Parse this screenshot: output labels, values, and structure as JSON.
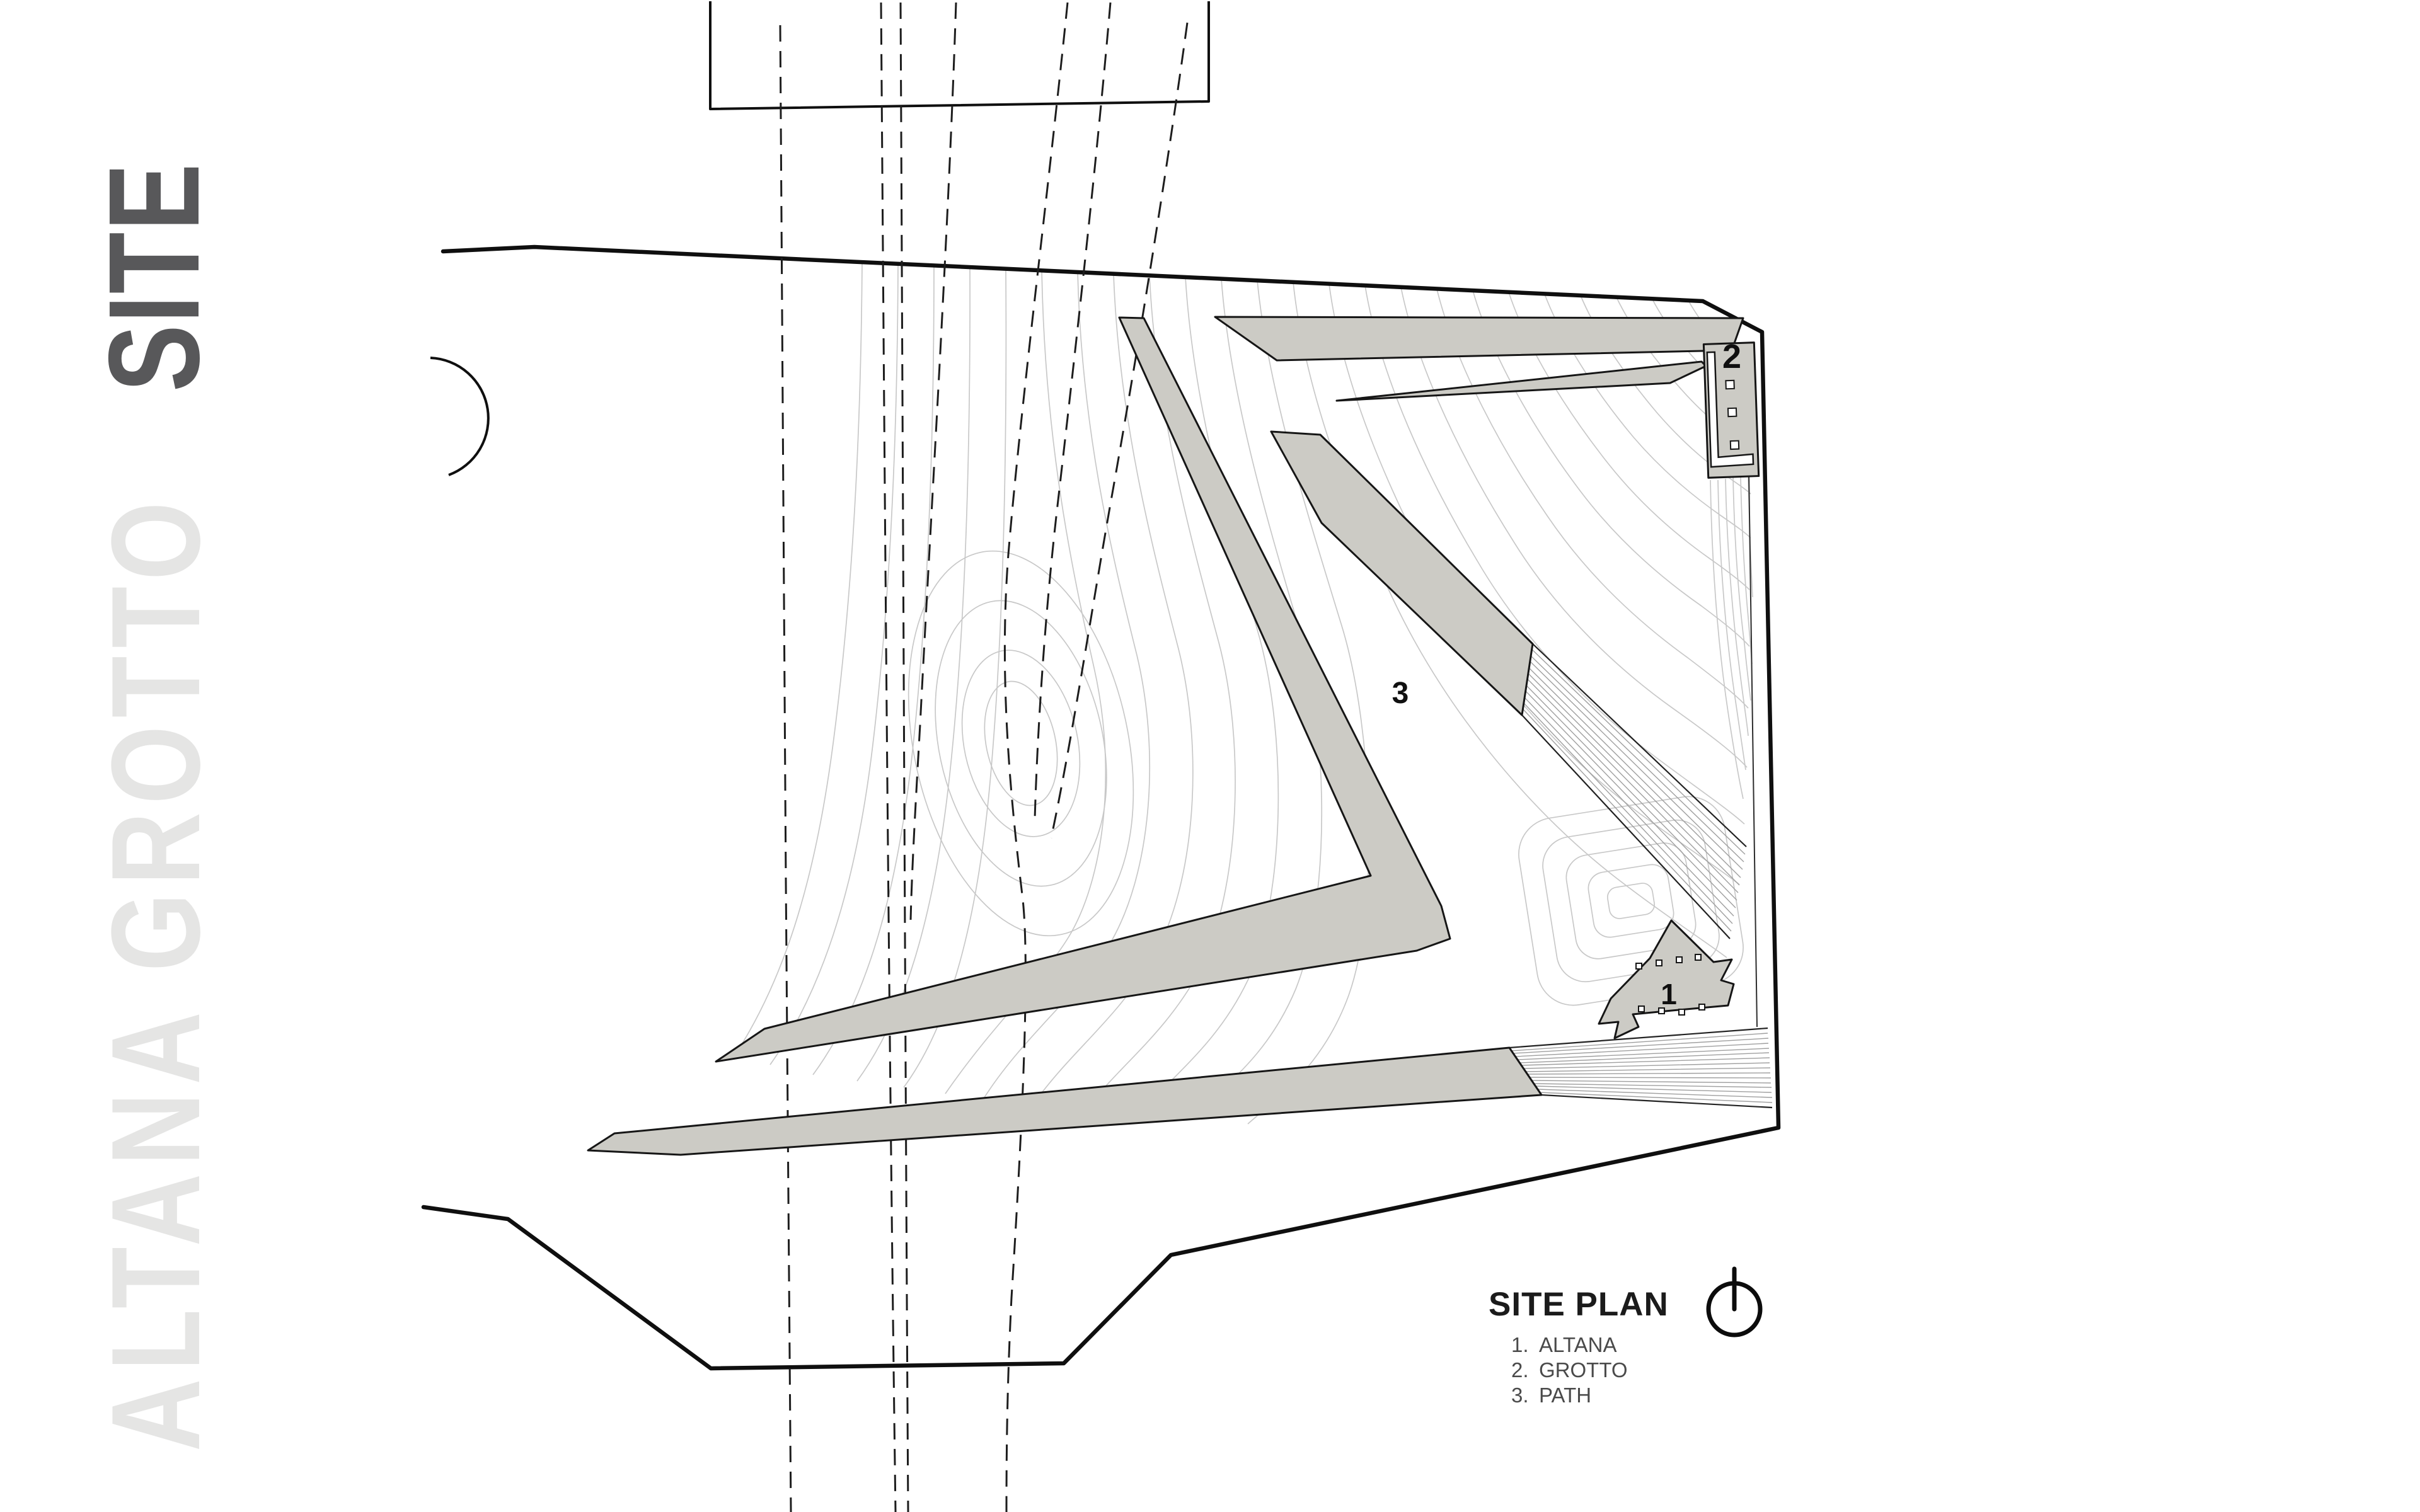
{
  "titles": {
    "main": "SITE",
    "side": "ALTANA GROTTO"
  },
  "legend": {
    "heading": "SITE PLAN",
    "items": [
      {
        "number": "1.",
        "label": "ALTANA"
      },
      {
        "number": "2.",
        "label": "GROTTO"
      },
      {
        "number": "3.",
        "label": "PATH"
      }
    ]
  },
  "plan": {
    "labels": {
      "altana": "1",
      "grotto": "2",
      "path": "3"
    }
  },
  "colors": {
    "paper": "#ffffff",
    "path_fill": "#cccbc5",
    "path_stroke": "#161616",
    "boundary": "#0f0f0f",
    "contour": "#c8c8c8",
    "hatch": "#9f9f9f",
    "dashed": "#1d1d1d",
    "title_dark": "#58585a",
    "title_light": "#e5e5e4",
    "legend_head": "#1b1b1b",
    "legend_item": "#4a4a4a"
  }
}
